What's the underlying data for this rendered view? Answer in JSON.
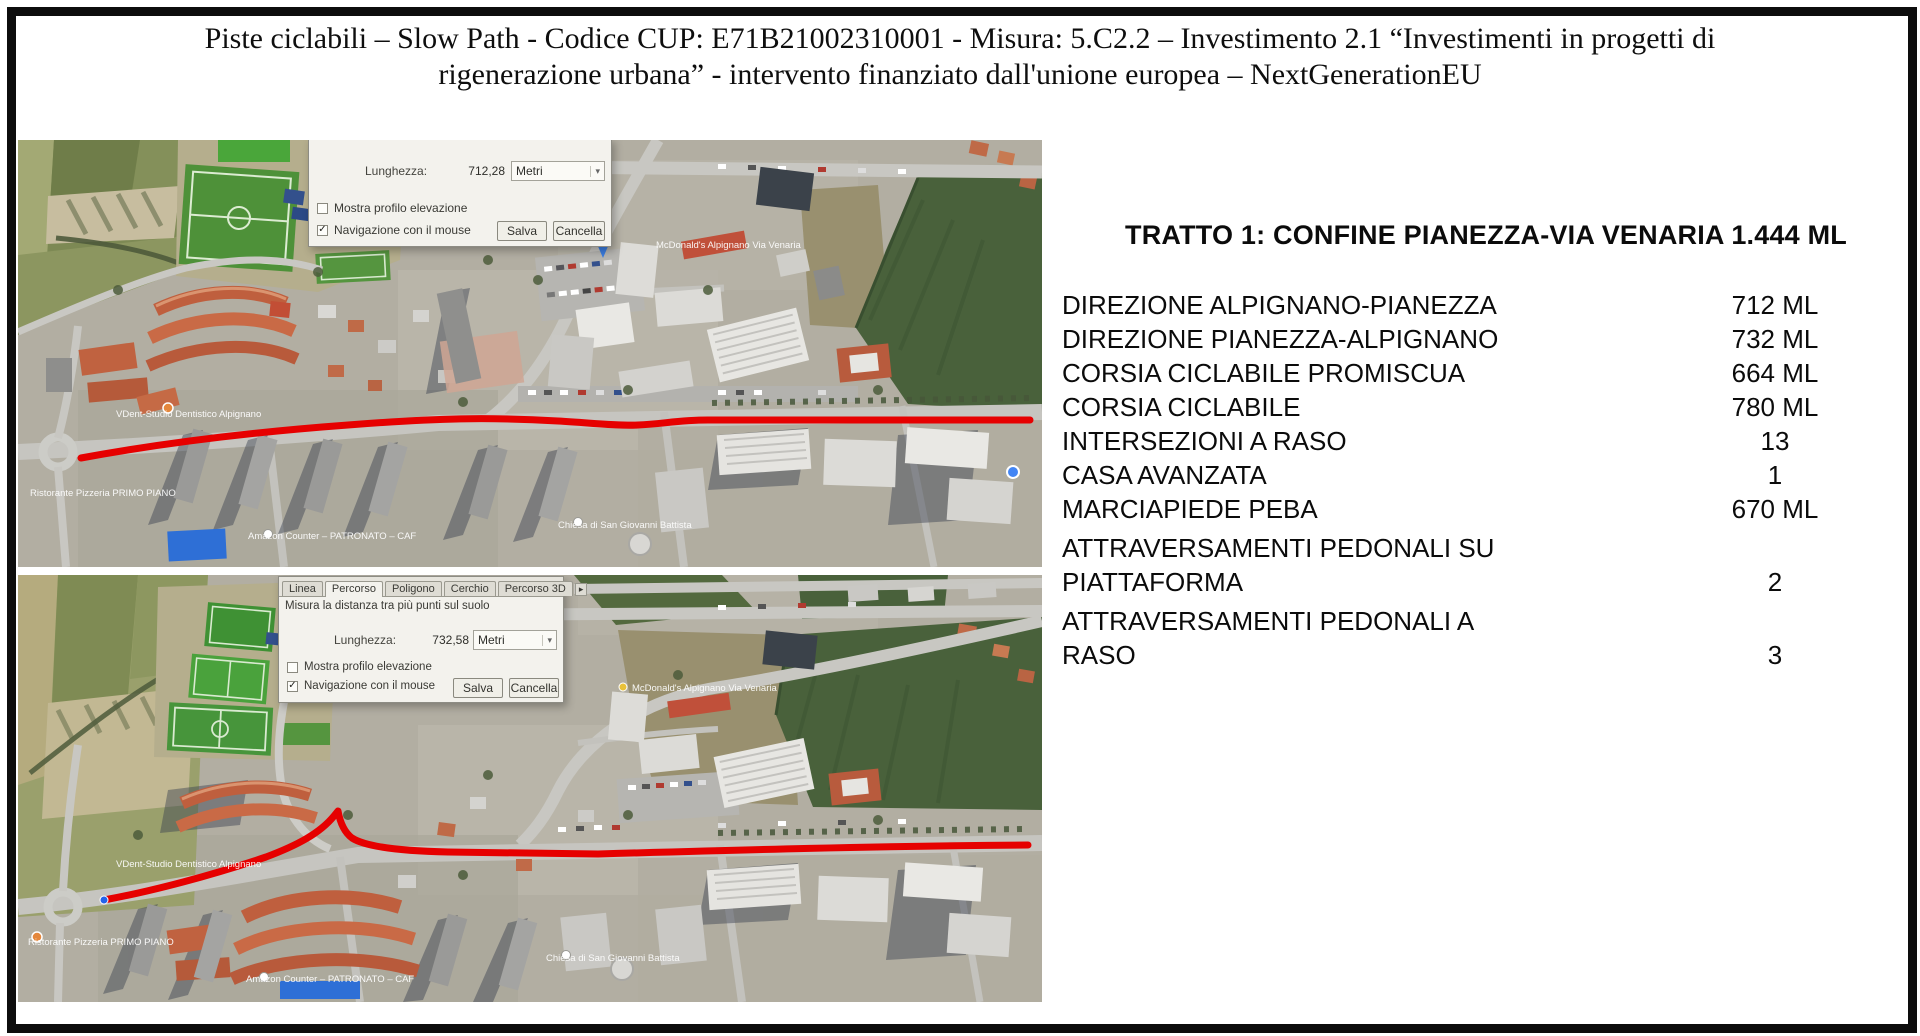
{
  "header": {
    "title_line1": "Piste ciclabili – Slow Path - Codice CUP: E71B21002310001 - Misura: 5.C2.2 – Investimento 2.1 “Investimenti in progetti di",
    "title_line2": "rigenerazione urbana” - intervento finanziato dall'unione europea – NextGenerationEU"
  },
  "colors": {
    "route_red": "#e60000",
    "frame_black": "#0d0d0d",
    "field_dark_green": "#49613b",
    "pitch_green": "#4e9139",
    "roof_orange": "#bf5f3e",
    "dialog_bg": "#f3f2ed"
  },
  "dialog_common": {
    "length_label": "Lunghezza:",
    "unit": "Metri",
    "elevation_label": "Mostra profilo elevazione",
    "mouse_nav_label": "Navigazione con il mouse",
    "save_label": "Salva",
    "cancel_label": "Cancella",
    "checkmark": "✓",
    "dropdown_arrow": "▾",
    "tab_overflow_arrow": "▸"
  },
  "map_top": {
    "dialog": {
      "length_value": "712,28"
    }
  },
  "map_bottom": {
    "dialog": {
      "tabs": [
        "Linea",
        "Percorso",
        "Poligono",
        "Cerchio",
        "Percorso 3D"
      ],
      "active_tab": "Percorso",
      "description": "Misura la distanza tra più punti sul suolo",
      "length_value": "732,58"
    }
  },
  "map_labels": {
    "vdent": "VDent-Studio Dentistico Alpignano",
    "ristorante": "Ristorante Pizzeria PRIMO PIANO",
    "amazon": "Amazon Counter – PATRONATO – CAF",
    "chiesa": "Chiesa di San Giovanni Battista",
    "mcdonalds": "McDonald's Alpignano Via Venaria"
  },
  "panel": {
    "heading": "TRATTO 1: CONFINE PIANEZZA-VIA VENARIA 1.444 ML",
    "rows": [
      {
        "label": "DIREZIONE ALPIGNANO-PIANEZZA",
        "value": "712 ML"
      },
      {
        "label": "DIREZIONE PIANEZZA-ALPIGNANO",
        "value": "732 ML"
      },
      {
        "label": "CORSIA CICLABILE PROMISCUA",
        "value": "664 ML"
      },
      {
        "label": "CORSIA CICLABILE",
        "value": "780 ML"
      },
      {
        "label": "INTERSEZIONI A RASO",
        "value": "13"
      },
      {
        "label": "CASA AVANZATA",
        "value": "1"
      },
      {
        "label": "MARCIAPIEDE PEBA",
        "value": "670 ML"
      },
      {
        "label": "ATTRAVERSAMENTI PEDONALI SU PIATTAFORMA",
        "value": "2"
      },
      {
        "label": "ATTRAVERSAMENTI PEDONALI A RASO",
        "value": "3"
      }
    ]
  }
}
